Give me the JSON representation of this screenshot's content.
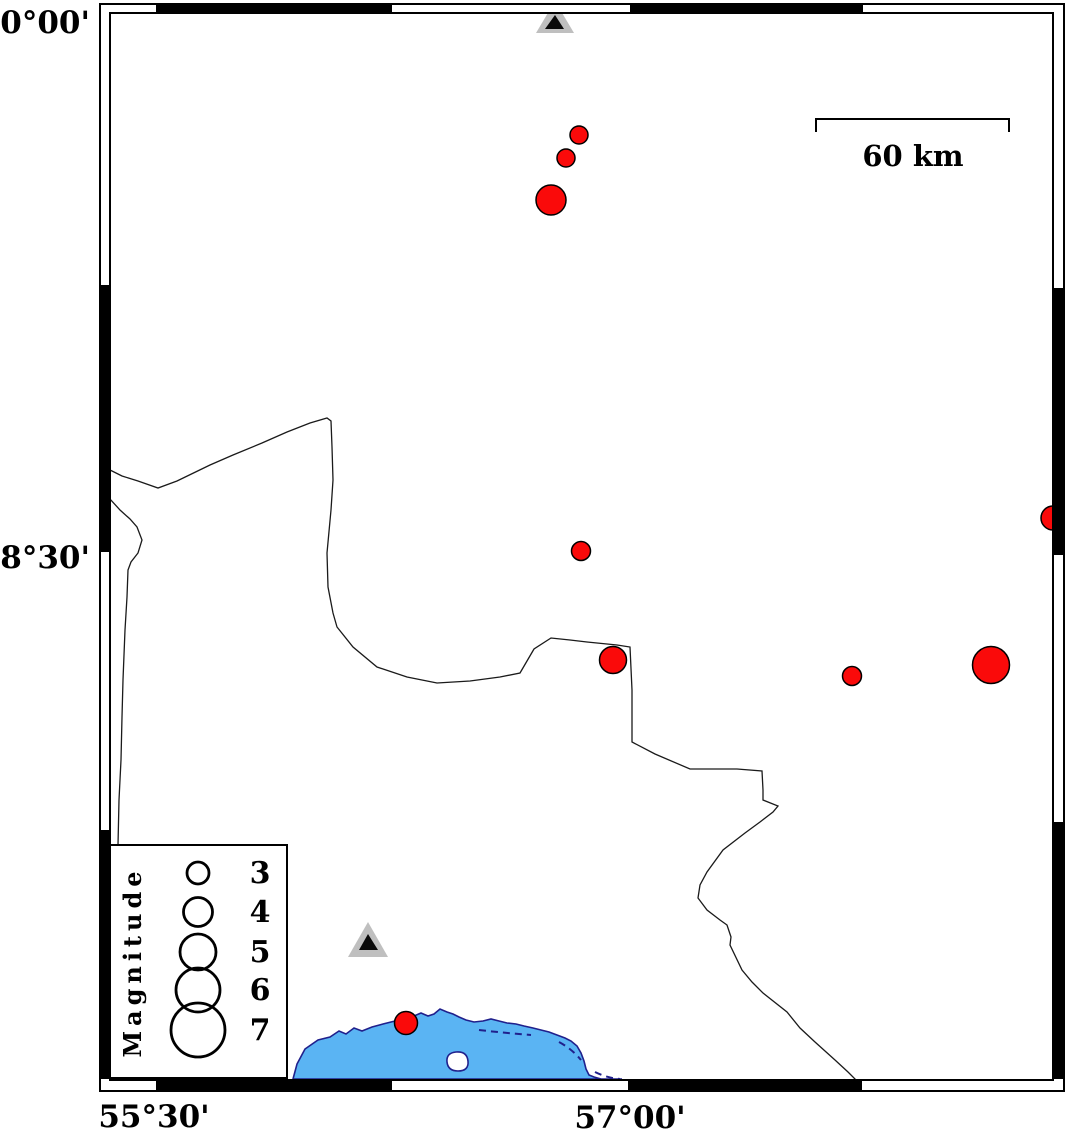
{
  "map": {
    "description": "Seismicity map with earthquake epicenters, seismic stations, magnitude legend and scale bar",
    "colors": {
      "background": "#ffffff",
      "frame": "#000000",
      "earthquake_fill": "#fa0a0a",
      "earthquake_stroke": "#000000",
      "station_outer": "#bfbfbf",
      "station_inner": "#0a0a0a",
      "boundary_line": "#1a1a1a",
      "sea_fill": "#5ab4f3",
      "coast_stroke": "#20208c",
      "legend_bg": "#ffffff"
    },
    "frame": {
      "outer": {
        "x": 100,
        "y": 4,
        "w": 964,
        "h": 1087
      },
      "inner": {
        "x": 110,
        "y": 13,
        "w": 943,
        "h": 1067
      },
      "band_black": {
        "top": [
          [
            156,
            392
          ],
          [
            630,
            863
          ]
        ],
        "bottom": [
          [
            156,
            392
          ],
          [
            628,
            862
          ]
        ],
        "left": [
          [
            285,
            552
          ],
          [
            830,
            1079
          ]
        ],
        "right": [
          [
            288,
            555
          ],
          [
            822,
            1079
          ]
        ]
      }
    },
    "axis_labels": {
      "top_left": "30°00'",
      "mid_left": "28°30'",
      "bottom_left": "55°30'",
      "bottom_mid": "57°00'"
    },
    "axis_label_pos": {
      "top_left": {
        "x": 90,
        "y": 33
      },
      "mid_left": {
        "x": 90,
        "y": 568
      },
      "bottom_left": {
        "x": 154,
        "y": 1127
      },
      "bottom_mid": {
        "x": 630,
        "y": 1128
      }
    },
    "scale_bar": {
      "label": "60 km",
      "x1": 816,
      "x2": 1009,
      "y": 119,
      "tick_drop": 13,
      "label_x": 913,
      "label_y": 166
    },
    "legend": {
      "title": "Magnitude",
      "box": {
        "x": 110,
        "y": 845,
        "w": 177,
        "h": 233
      },
      "circle_cx": 198,
      "label_x": 260,
      "title_x": 141,
      "title_y": 962,
      "entries": [
        {
          "label": "3",
          "r": 11,
          "cy": 873
        },
        {
          "label": "4",
          "r": 14.5,
          "cy": 912
        },
        {
          "label": "5",
          "r": 18,
          "cy": 952
        },
        {
          "label": "6",
          "r": 22,
          "cy": 990
        },
        {
          "label": "7",
          "r": 27,
          "cy": 1030
        }
      ]
    },
    "stations": [
      {
        "name": "station-north",
        "outer": "536,33 574,33 555,1",
        "inner": "545,29 564,29 555,15"
      },
      {
        "name": "station-south",
        "outer": "348,957 388,957 368,922",
        "inner": "359,950 378,950 368,934"
      }
    ],
    "earthquakes": [
      {
        "x": 579,
        "y": 135,
        "r": 9,
        "magnitude_approx": "2.5"
      },
      {
        "x": 566,
        "y": 158,
        "r": 9,
        "magnitude_approx": "2.5"
      },
      {
        "x": 551,
        "y": 200,
        "r": 15,
        "magnitude_approx": "4.0"
      },
      {
        "x": 581,
        "y": 551,
        "r": 9.5,
        "magnitude_approx": "2.6"
      },
      {
        "x": 613,
        "y": 660,
        "r": 13.5,
        "magnitude_approx": "3.6"
      },
      {
        "x": 852,
        "y": 676,
        "r": 9.5,
        "magnitude_approx": "2.6"
      },
      {
        "x": 991,
        "y": 665,
        "r": 18.5,
        "magnitude_approx": "5.0"
      },
      {
        "x": 1053,
        "y": 518,
        "r": 12,
        "magnitude_approx": "3.3"
      },
      {
        "x": 406,
        "y": 1023,
        "r": 11.5,
        "magnitude_approx": "3.1"
      }
    ],
    "geo": {
      "boundary_north": "M110,470 L122,476 138,481 158,488 177,481 210,465 233,455 262,443 287,432 310,423 327,418 331,421 332,447 333,480 331,510 327,553 328,587 333,613 337,627 353,647 377,667 407,677 437,683 470,681 500,677 520,673 534,649 551,638 570,640 587,642 617,645 630,647 632,690 632,742 655,754 690,769 720,769 737,769 762,771 763,790 763,800 778,806 773,812 760,822 745,833 723,850 707,872 700,885 698,898 707,910 720,920 727,925 731,937 730,945 742,970 752,982 763,993 787,1012 800,1028 815,1042 835,1060 848,1072 857,1081",
      "boundary_west": "M110,499 L120,510 130,519 137,527 142,540 138,553 131,562 128,570 127,597 125,630 123,680 122,717 121,760 119,800 118,845",
      "sea": "M293,1079 L297,1064 305,1049 318,1040 330,1037 339,1031 346,1034 354,1028 362,1031 372,1027 383,1024 395,1021 406,1019 414,1016 421,1013 428,1016 434,1014 440,1009 447,1012 453,1014 459,1017 466,1020 474,1022 483,1021 491,1019 499,1021 507,1023 516,1024 524,1026 533,1028 541,1030 549,1032 557,1035 565,1038 571,1041 577,1046 581,1053 584,1061 586,1069 589,1075 594,1077 601,1079 610,1080 622,1079 Z",
      "island": "M447,1062 Q446,1053 456,1052 Q467,1051 468,1061 Q469,1071 458,1071 Q448,1071 447,1062 Z",
      "mudflat_dashes": [
        "M479,1030 Q505,1033 531,1035",
        "M559,1042 Q572,1049 581,1060",
        "M595,1072 q12,6 25,7"
      ]
    }
  }
}
